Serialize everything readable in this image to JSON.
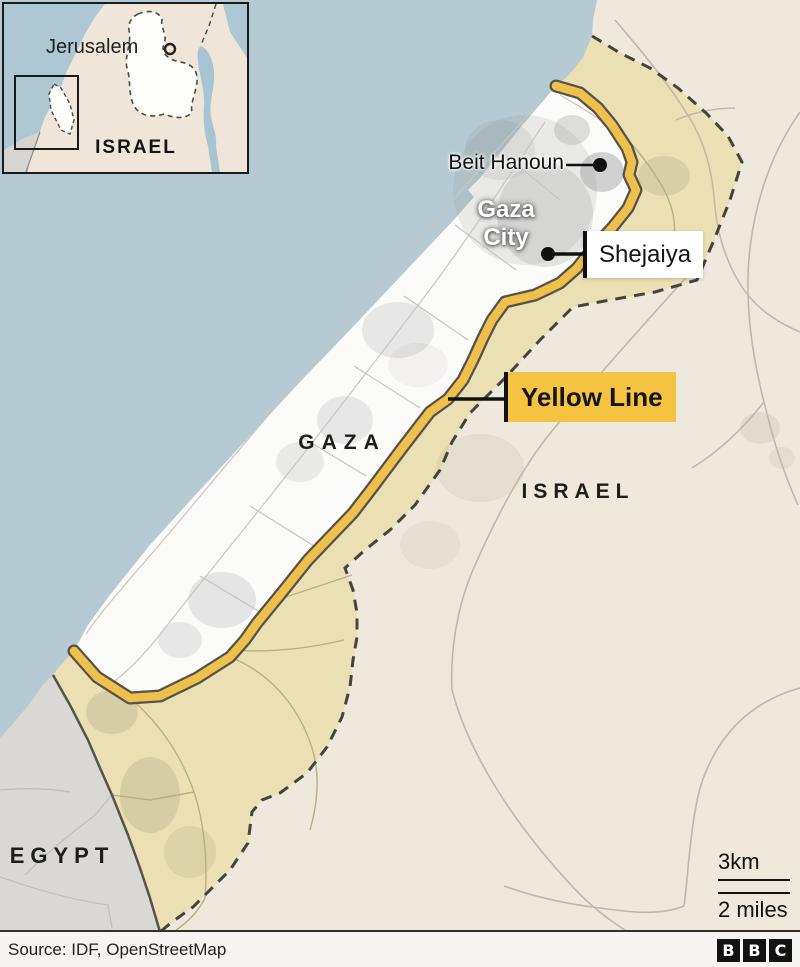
{
  "inset": {
    "jerusalem": "Jerusalem",
    "israel": "ISRAEL"
  },
  "callouts": {
    "beit_hanoun": "Beit Hanoun",
    "gaza_city_1": "Gaza",
    "gaza_city_2": "City",
    "shejaiya": "Shejaiya",
    "yellow_line": "Yellow Line"
  },
  "regions": {
    "gaza": "GAZA",
    "israel": "ISRAEL",
    "egypt": "EGYPT"
  },
  "scale": {
    "metric": "3km",
    "imperial": "2 miles"
  },
  "footer": {
    "source": "Source: IDF, OpenStreetMap",
    "logo": [
      "B",
      "B",
      "C"
    ]
  },
  "colors": {
    "sea": "#B5CAD2",
    "land": "#EFE8DD",
    "buffer": "#EAE0B4",
    "egypt": "#D9D8D5",
    "gaza": "#FBFBFA",
    "yellow": "#EDC14B",
    "yellow-casing": "#56514A",
    "border": "#45433E",
    "label-yellow": "#F3C341",
    "footer-bg": "#F7F5F1"
  }
}
